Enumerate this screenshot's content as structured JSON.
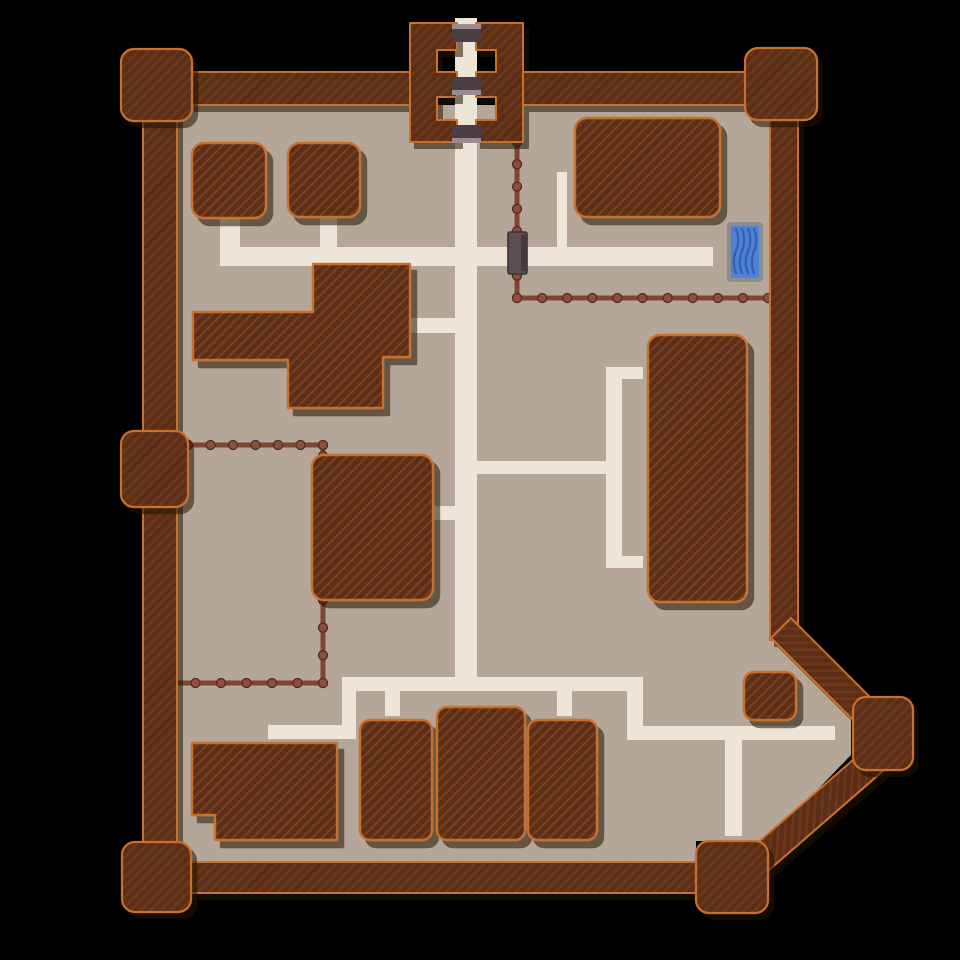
{
  "map": {
    "canvas": {
      "width": 960,
      "height": 960
    },
    "colors": {
      "background": "#000000",
      "ground": "#b4a698",
      "path": "#ece5d8",
      "wall_fill": "#5b2d16",
      "wall_stripe": "#6b381d",
      "building_fill": "#5d2e17",
      "building_stripe": "#754123",
      "outline_orange": "#c8702f",
      "shadow": "#1c0b04",
      "fence_line": "#7f4533",
      "fence_post": "#8d4f3c",
      "fence_post_edge": "#512c1c",
      "gate_bar_dark": "#4a3e44",
      "gate_bar_light": "#9b8d8f",
      "fence_gate_fill": "#5b4e55",
      "fence_gate_edge": "#3a3136",
      "fence_gate_band": "#453a40",
      "trough_border": "#8d8d8d",
      "trough_water": "#4d82d8",
      "trough_wave": "#3561ae"
    },
    "ground_polygon": [
      [
        177,
        105
      ],
      [
        770,
        105
      ],
      [
        770,
        631
      ],
      [
        851,
        712
      ],
      [
        851,
        755
      ],
      [
        768,
        841
      ],
      [
        696,
        841
      ],
      [
        696,
        862
      ],
      [
        177,
        862
      ]
    ],
    "walls": [
      {
        "name": "wall-top-left",
        "x": 190,
        "y": 72,
        "w": 222,
        "h": 33
      },
      {
        "name": "wall-top-right",
        "x": 521,
        "y": 72,
        "w": 226,
        "h": 33
      },
      {
        "name": "wall-west",
        "x": 143,
        "y": 100,
        "w": 34,
        "h": 750
      },
      {
        "name": "wall-east",
        "x": 770,
        "y": 100,
        "w": 28,
        "h": 540
      },
      {
        "name": "wall-bottom",
        "x": 180,
        "y": 862,
        "w": 520,
        "h": 31
      },
      {
        "name": "wall-ne-diagonal",
        "x": 762,
        "y": 660,
        "w": 130,
        "h": 28,
        "rotate": 45
      },
      {
        "name": "wall-se-diagonal",
        "x": 715,
        "y": 804,
        "w": 185,
        "h": 28,
        "rotate": -41
      }
    ],
    "towers": [
      {
        "name": "tower-top-left",
        "x": 121,
        "y": 49,
        "w": 71,
        "h": 72
      },
      {
        "name": "tower-top-right",
        "x": 745,
        "y": 48,
        "w": 72,
        "h": 72
      },
      {
        "name": "tower-mid-west",
        "x": 121,
        "y": 431,
        "w": 67,
        "h": 76
      },
      {
        "name": "tower-bottom-left",
        "x": 122,
        "y": 842,
        "w": 69,
        "h": 70
      },
      {
        "name": "tower-bottom-center",
        "x": 696,
        "y": 841,
        "w": 72,
        "h": 72
      },
      {
        "name": "tower-east-point",
        "x": 853,
        "y": 697,
        "w": 60,
        "h": 73
      }
    ],
    "gatehouse": {
      "left_block": [
        [
          410,
          23
        ],
        [
          457,
          23
        ],
        [
          457,
          50
        ],
        [
          437,
          50
        ],
        [
          437,
          72
        ],
        [
          457,
          72
        ],
        [
          457,
          97
        ],
        [
          437,
          97
        ],
        [
          437,
          120
        ],
        [
          457,
          120
        ],
        [
          457,
          142
        ],
        [
          410,
          142
        ]
      ],
      "right_block": [
        [
          523,
          23
        ],
        [
          476,
          23
        ],
        [
          476,
          50
        ],
        [
          496,
          50
        ],
        [
          496,
          72
        ],
        [
          476,
          72
        ],
        [
          476,
          97
        ],
        [
          496,
          97
        ],
        [
          496,
          120
        ],
        [
          476,
          120
        ],
        [
          476,
          142
        ],
        [
          523,
          142
        ]
      ],
      "bars": [
        {
          "x": 452,
          "y": 29,
          "w": 29,
          "h": 13,
          "light": "above"
        },
        {
          "x": 452,
          "y": 77,
          "w": 29,
          "h": 13,
          "light": "below"
        },
        {
          "x": 452,
          "y": 125,
          "w": 29,
          "h": 13,
          "light": "below"
        }
      ]
    },
    "paths": [
      {
        "name": "path-main-vertical",
        "x": 455,
        "y": 18,
        "w": 22,
        "h": 672
      },
      {
        "name": "path-nw-horizontal",
        "x": 220,
        "y": 247,
        "w": 493,
        "h": 19
      },
      {
        "name": "path-stub-hut-a",
        "x": 220,
        "y": 218,
        "w": 20,
        "h": 32
      },
      {
        "name": "path-stub-hut-b",
        "x": 320,
        "y": 218,
        "w": 17,
        "h": 32
      },
      {
        "name": "path-ne-stub",
        "x": 557,
        "y": 172,
        "w": 10,
        "h": 78
      },
      {
        "name": "path-west-stub",
        "x": 411,
        "y": 318,
        "w": 46,
        "h": 15
      },
      {
        "name": "path-mid-horizontal",
        "x": 477,
        "y": 461,
        "w": 130,
        "h": 13
      },
      {
        "name": "path-bracket-vertical",
        "x": 606,
        "y": 367,
        "w": 16,
        "h": 201
      },
      {
        "name": "path-bracket-top-arm",
        "x": 620,
        "y": 367,
        "w": 23,
        "h": 12
      },
      {
        "name": "path-bracket-bottom-arm",
        "x": 620,
        "y": 556,
        "w": 23,
        "h": 12
      },
      {
        "name": "path-stub-center-building",
        "x": 433,
        "y": 506,
        "w": 24,
        "h": 14
      },
      {
        "name": "path-south-horizontal",
        "x": 342,
        "y": 677,
        "w": 301,
        "h": 14
      },
      {
        "name": "path-south-connector",
        "x": 627,
        "y": 677,
        "w": 16,
        "h": 63
      },
      {
        "name": "path-se-horizontal",
        "x": 627,
        "y": 726,
        "w": 208,
        "h": 14
      },
      {
        "name": "path-se-stub-down",
        "x": 725,
        "y": 740,
        "w": 17,
        "h": 96
      },
      {
        "name": "path-sw-elbow-vertical",
        "x": 342,
        "y": 677,
        "w": 14,
        "h": 61
      },
      {
        "name": "path-sw-elbow-horizontal",
        "x": 268,
        "y": 725,
        "w": 88,
        "h": 14
      },
      {
        "name": "path-stub-row-1",
        "x": 385,
        "y": 690,
        "w": 15,
        "h": 26
      },
      {
        "name": "path-stub-row-2",
        "x": 557,
        "y": 690,
        "w": 15,
        "h": 26
      }
    ],
    "fences": [
      {
        "name": "fence-ne-yard",
        "points": [
          [
            517,
            142
          ],
          [
            517,
            298
          ],
          [
            768,
            298
          ]
        ]
      },
      {
        "name": "fence-sw-top",
        "points": [
          [
            188,
            445
          ],
          [
            323,
            445
          ],
          [
            323,
            456
          ]
        ]
      },
      {
        "name": "fence-sw-bottom",
        "points": [
          [
            323,
            600
          ],
          [
            323,
            683
          ],
          [
            170,
            683
          ]
        ]
      }
    ],
    "fence_gate": {
      "name": "fence-gate",
      "x": 508,
      "y": 232,
      "w": 19,
      "h": 42
    },
    "buildings": [
      {
        "name": "building-nw-hut-a",
        "type": "rect",
        "x": 192,
        "y": 143,
        "w": 74,
        "h": 75,
        "rx": 12
      },
      {
        "name": "building-nw-hut-b",
        "type": "rect",
        "x": 288,
        "y": 143,
        "w": 72,
        "h": 74,
        "rx": 12
      },
      {
        "name": "building-west-hall",
        "type": "poly",
        "points": [
          [
            313,
            264
          ],
          [
            410,
            264
          ],
          [
            410,
            357
          ],
          [
            383,
            357
          ],
          [
            383,
            408
          ],
          [
            288,
            408
          ],
          [
            288,
            360
          ],
          [
            193,
            360
          ],
          [
            193,
            312
          ],
          [
            313,
            312
          ]
        ]
      },
      {
        "name": "building-ne-large",
        "type": "rect",
        "x": 575,
        "y": 118,
        "w": 145,
        "h": 99,
        "rx": 12
      },
      {
        "name": "building-east-longhouse",
        "type": "rect",
        "x": 648,
        "y": 335,
        "w": 99,
        "h": 267,
        "rx": 12
      },
      {
        "name": "building-center-stable",
        "type": "rect",
        "x": 312,
        "y": 455,
        "w": 121,
        "h": 145,
        "rx": 12
      },
      {
        "name": "building-sw-lodge",
        "type": "poly",
        "points": [
          [
            192,
            743
          ],
          [
            337,
            743
          ],
          [
            337,
            840
          ],
          [
            215,
            840
          ],
          [
            215,
            815
          ],
          [
            192,
            815
          ]
        ]
      },
      {
        "name": "building-south-row-1",
        "type": "rect",
        "x": 360,
        "y": 720,
        "w": 72,
        "h": 120,
        "rx": 10
      },
      {
        "name": "building-south-row-2",
        "type": "rect",
        "x": 437,
        "y": 707,
        "w": 88,
        "h": 133,
        "rx": 10
      },
      {
        "name": "building-south-row-3",
        "type": "rect",
        "x": 528,
        "y": 720,
        "w": 69,
        "h": 120,
        "rx": 10
      },
      {
        "name": "building-se-hut",
        "type": "rect",
        "x": 744,
        "y": 672,
        "w": 52,
        "h": 48,
        "rx": 10
      }
    ],
    "water_trough": {
      "name": "water-trough",
      "x": 727,
      "y": 222,
      "w": 36,
      "h": 60,
      "border": 4,
      "waves": 4
    }
  }
}
